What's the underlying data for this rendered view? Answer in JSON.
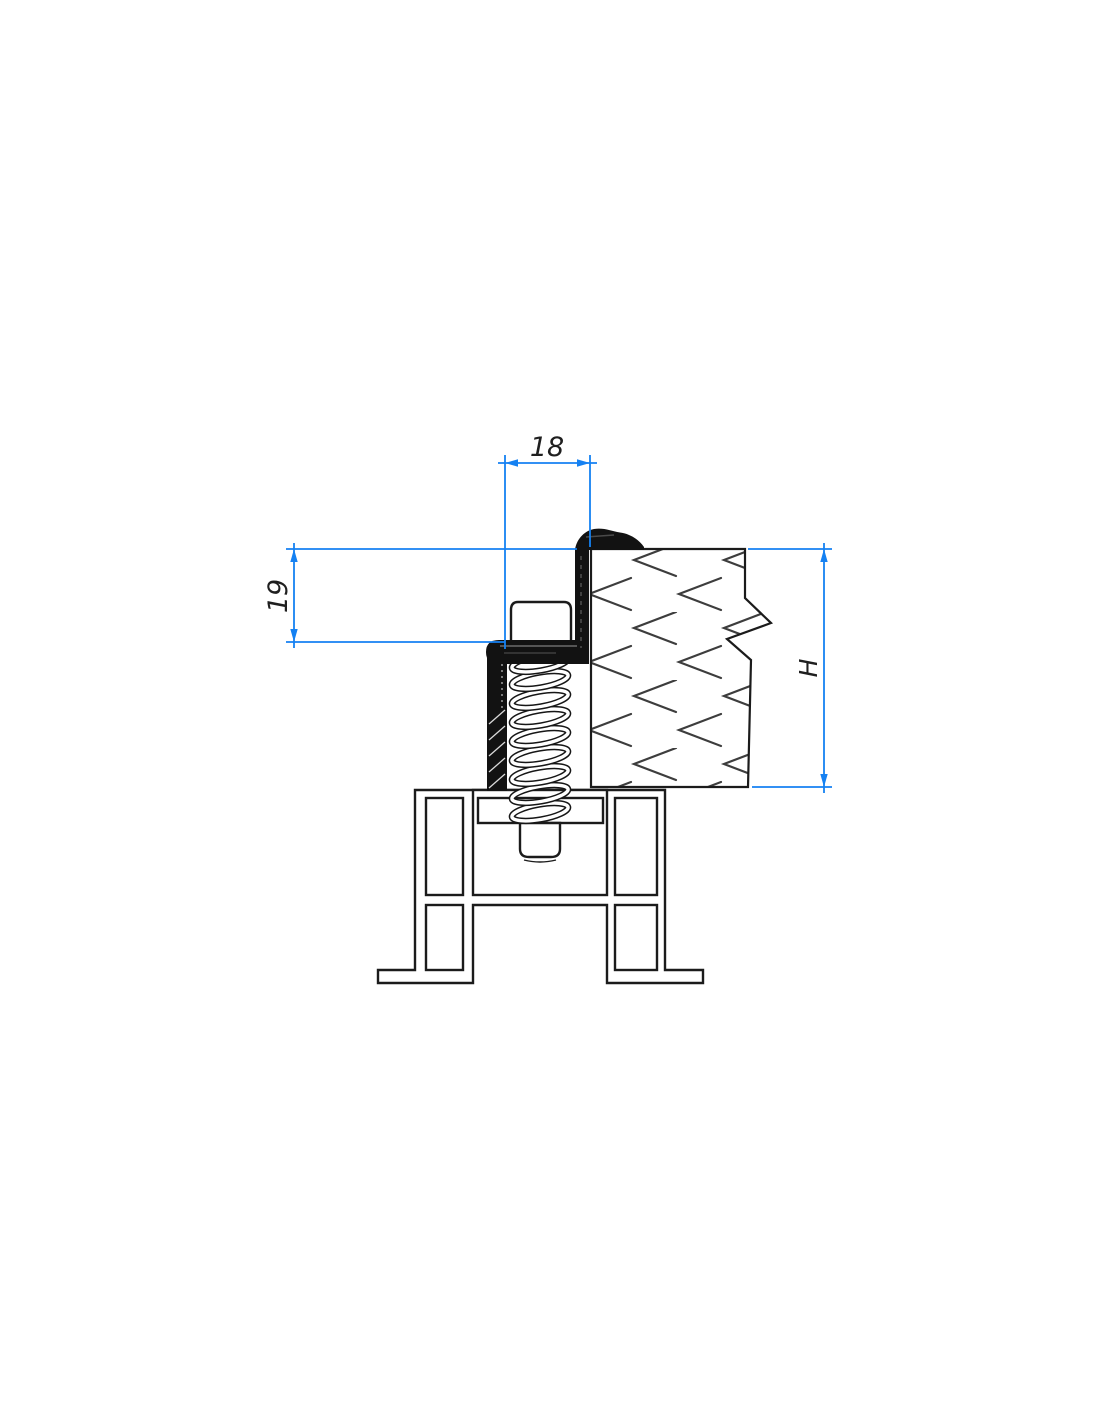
{
  "dimensions": {
    "top_width": "18",
    "left_height": "19",
    "right_height": "H"
  },
  "colors": {
    "dimension_line": "#1581f2",
    "drawing_line": "#1b1b1b",
    "hatch_line": "#3d3d3d",
    "gasket_fill": "#121212",
    "background": "#ffffff"
  }
}
